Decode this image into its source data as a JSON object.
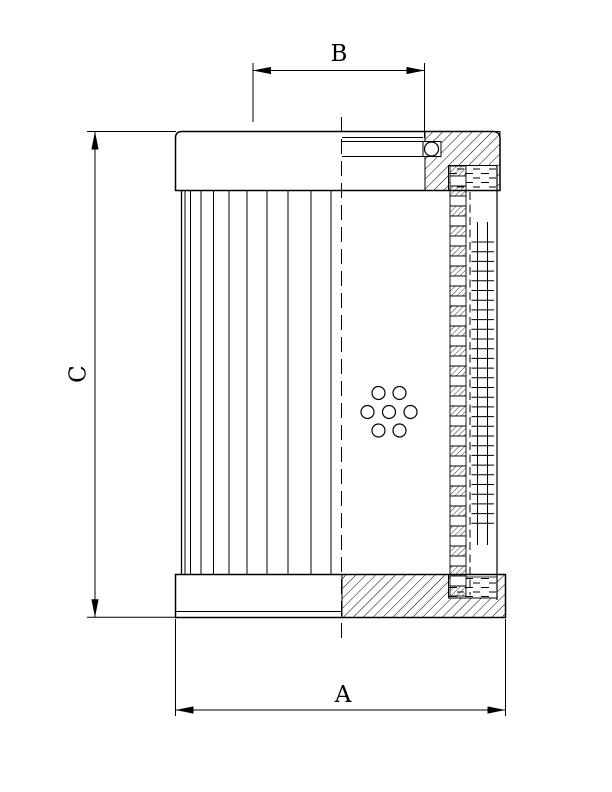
{
  "page": {
    "background_color": "#ffffff"
  },
  "drawing": {
    "description": "Technical section drawing of a cylindrical filter element with pleated media, perforated core tube, support mesh, end caps and O-ring seal",
    "line_color": "#000000",
    "labels": {
      "dim_top": "B",
      "dim_left": "C",
      "dim_bottom": "A"
    }
  }
}
